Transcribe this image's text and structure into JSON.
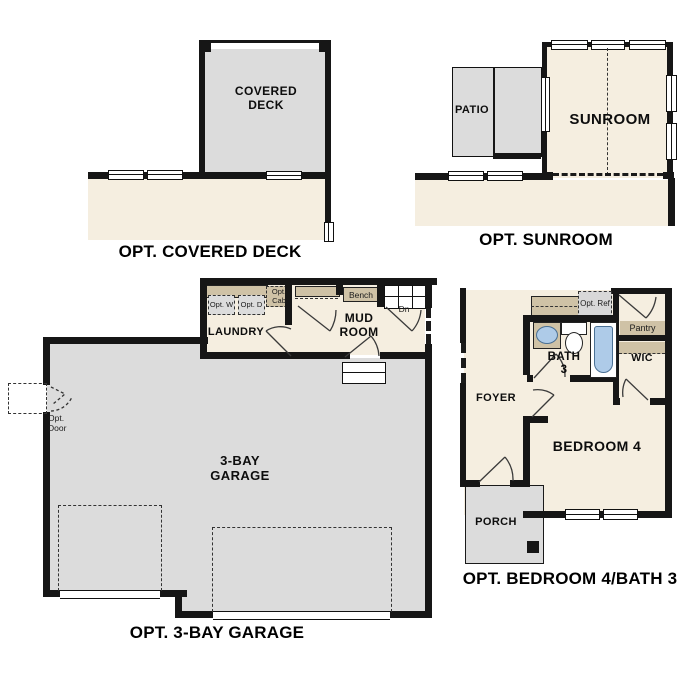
{
  "plans": {
    "covered_deck": {
      "caption": "OPT. COVERED DECK",
      "deck": "COVERED DECK"
    },
    "sunroom": {
      "caption": "OPT. SUNROOM",
      "sunroom": "SUNROOM",
      "patio": "PATIO"
    },
    "garage": {
      "caption": "OPT. 3-BAY GARAGE",
      "garage": "3-BAY GARAGE",
      "laundry": "LAUNDRY",
      "mudroom": "MUD ROOM",
      "bench": "Bench",
      "down": "Dn",
      "opt_washer": "Opt. W",
      "opt_dryer": "Opt. D",
      "opt_cab": "Opt. Cab",
      "opt_door": "Opt. Door"
    },
    "bedroom4": {
      "caption": "OPT. BEDROOM 4/BATH 3",
      "foyer": "FOYER",
      "bedroom": "BEDROOM 4",
      "bath": "BATH 3",
      "porch": "PORCH",
      "wic": "WIC",
      "pantry": "Pantry",
      "opt_ref": "Opt. Ref"
    }
  },
  "colors": {
    "wall": "#161616",
    "interior": "#f5eee0",
    "exterior_gray": "#dcdcdc",
    "cabinet_tan": "#cfc2a6",
    "fixture_blue": "#aecbe8"
  }
}
